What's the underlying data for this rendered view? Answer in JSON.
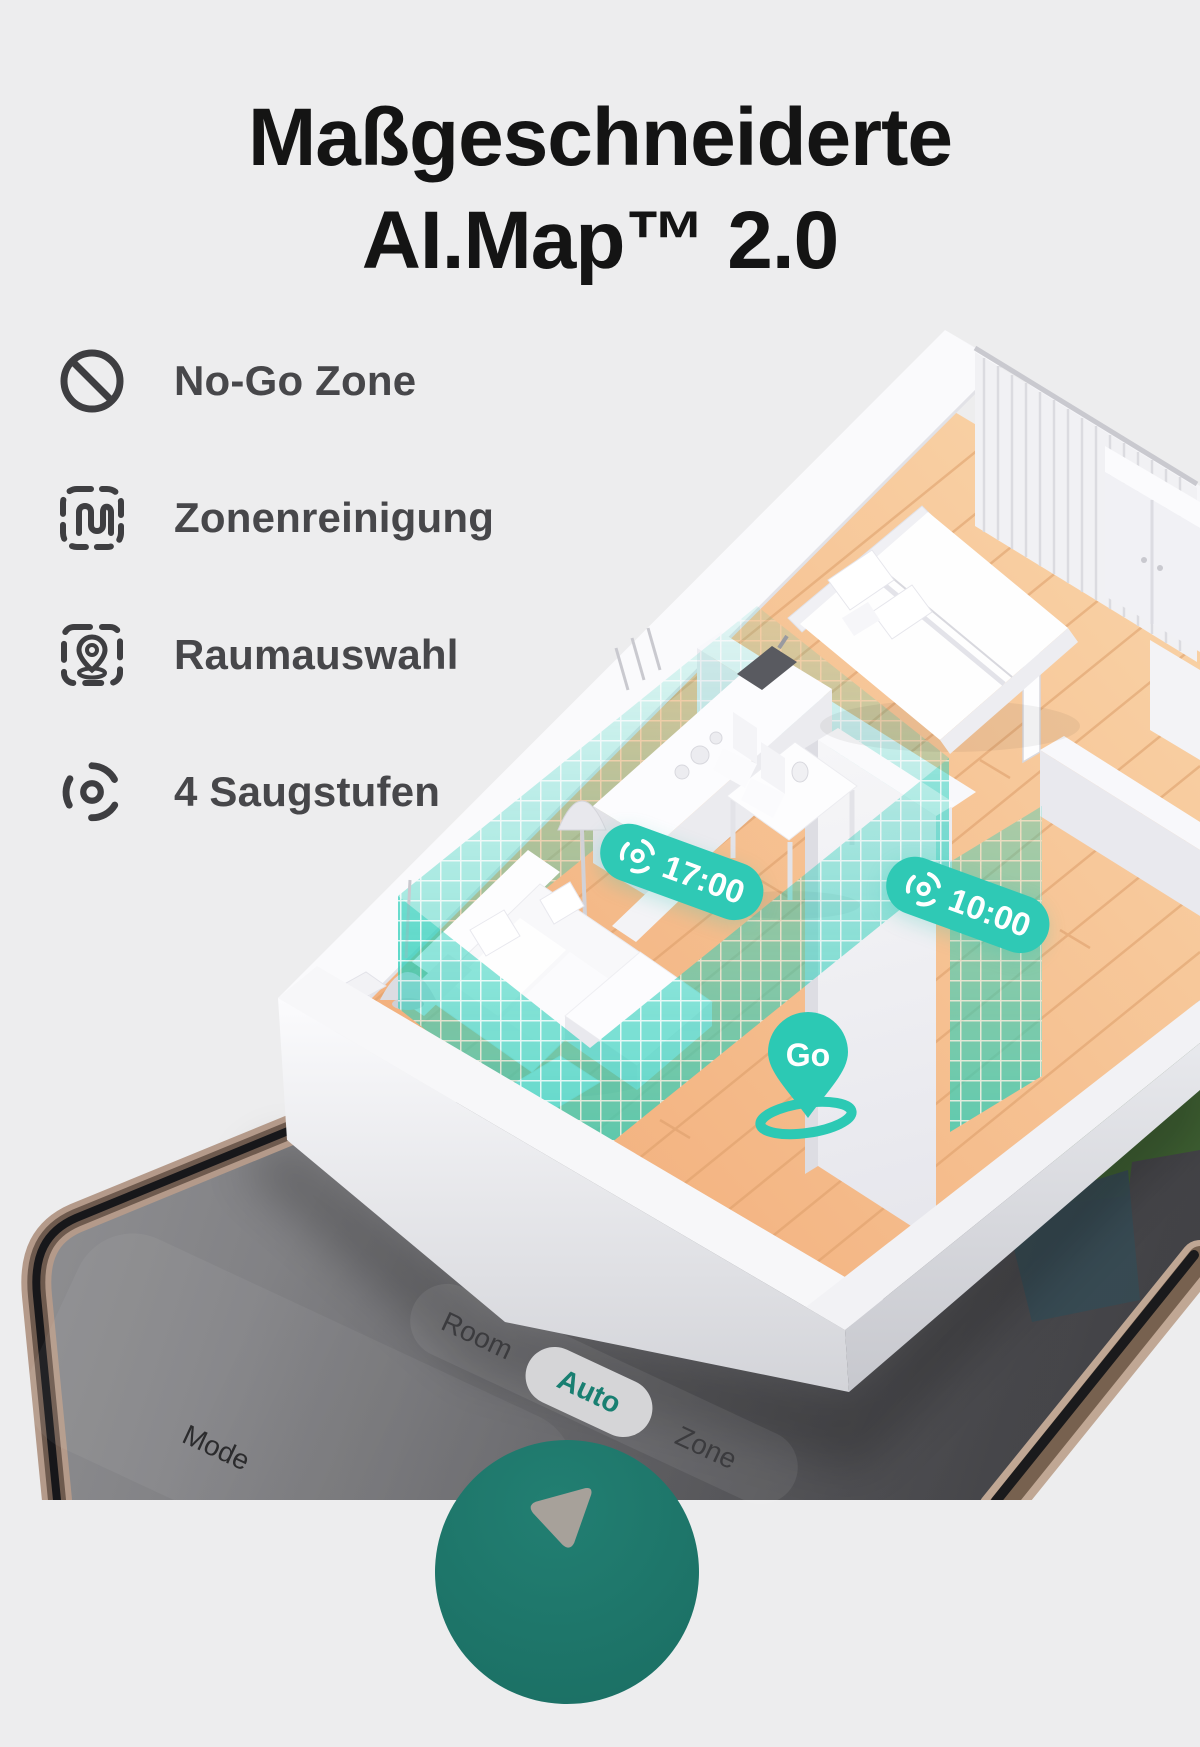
{
  "title": {
    "line1": "Maßgeschneiderte",
    "line2": "AI.Map™ 2.0"
  },
  "features": [
    {
      "label": "No-Go Zone",
      "icon": "no-go-icon"
    },
    {
      "label": "Zonenreinigung",
      "icon": "zone-cleaning-icon"
    },
    {
      "label": "Raumauswahl",
      "icon": "room-selection-icon"
    },
    {
      "label": "4 Saugstufen",
      "icon": "suction-levels-icon"
    }
  ],
  "scene": {
    "schedule_badges": [
      {
        "time": "17:00",
        "icon": "cyclone-icon"
      },
      {
        "time": "10:00",
        "icon": "cyclone-icon"
      }
    ],
    "go_pin": {
      "label": "Go"
    }
  },
  "phone": {
    "mode_selector": {
      "options": [
        "Room",
        "Auto",
        "Zone"
      ],
      "selected": "Auto"
    },
    "mode_label": "Mode",
    "mode_icon": "brush-icon",
    "start_button_icon": "start-arrow-icon"
  },
  "colors": {
    "background": "#EDEDEE",
    "accent_teal": "#2FC9B5",
    "start_button_teal": "#1E7C6F",
    "auto_text_teal": "#187F71",
    "floor_wood": "#F5BE8C",
    "title_text": "#141414",
    "feature_text": "#47474A",
    "map_green": "#4E7A3E",
    "map_slate": "#465F69",
    "phone_frame_bronze": "#B49A8A"
  }
}
